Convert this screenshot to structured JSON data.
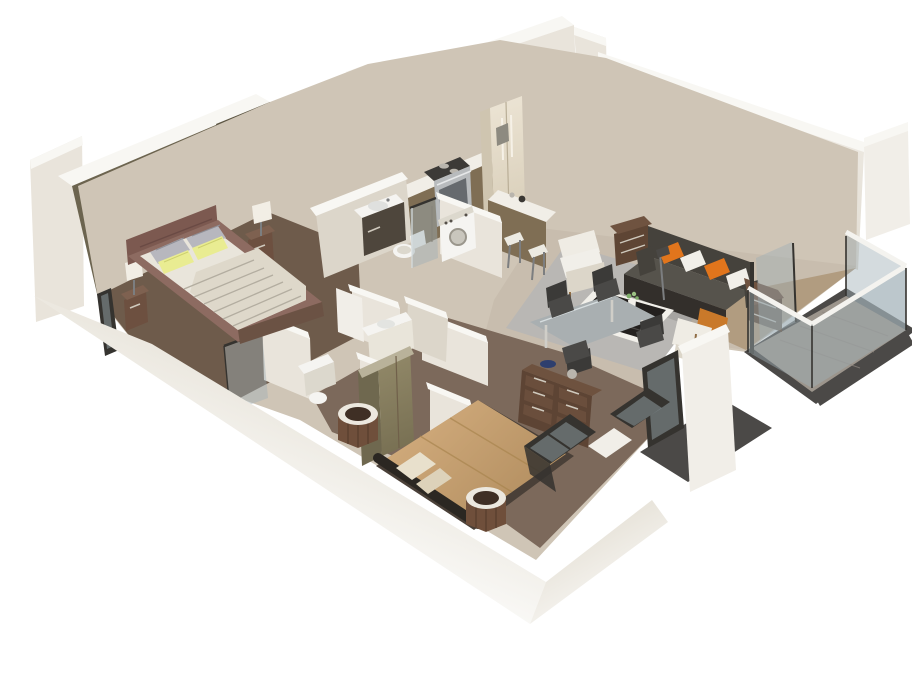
{
  "scene": {
    "title": "3D isometric cutaway floor plan render of a one-bedroom-plus-den apartment",
    "type": "isometric-cutaway-floor-plan",
    "background": "#ffffff",
    "rooms": [
      {
        "name": "master-bedroom",
        "features": [
          "abstract-pink-painting",
          "double-bed-striped-linens",
          "yellow-accent-pillows",
          "nightstands",
          "table-lamps",
          "olive-closet",
          "window"
        ]
      },
      {
        "name": "bathroom-main",
        "features": [
          "dark-vanity-white-sink",
          "toilet",
          "washer",
          "glass-shower-screen"
        ]
      },
      {
        "name": "bathroom-second",
        "features": [
          "white-sink-counter"
        ]
      },
      {
        "name": "ensuite-bathroom",
        "features": [
          "glass-shower-panel",
          "sink",
          "toilet"
        ]
      },
      {
        "name": "kitchen",
        "features": [
          "wood-upper-cabinets",
          "microwave",
          "marble-backsplash",
          "gas-range",
          "wood-base-cabinets",
          "refrigerator",
          "breakfast-bar",
          "bar-stools"
        ]
      },
      {
        "name": "entry",
        "features": [
          "wood-panel-door"
        ]
      },
      {
        "name": "living-room",
        "features": [
          "red-abstract-artwork",
          "dark-gray-sofa",
          "orange-and-white-pillows",
          "wood-end-tables",
          "black-coffee-table-white-frame",
          "flower-vase",
          "white-armchairs",
          "orange-back-armchair",
          "gray-area-rug",
          "floor-lamp",
          "sliding-glass-door"
        ]
      },
      {
        "name": "dining-area",
        "features": [
          "glass-top-table",
          "dark-chairs"
        ]
      },
      {
        "name": "second-bedroom",
        "features": [
          "tan-bed",
          "dark-bolster",
          "drum-side-tables",
          "six-drawer-dresser",
          "blue-bowl",
          "olive-wardrobe",
          "framed-windows"
        ]
      },
      {
        "name": "balcony",
        "features": [
          "glass-railing-white-cap",
          "dark-rim-floor"
        ]
      }
    ]
  },
  "palette": {
    "bg": "#ffffff",
    "wallTop": "#f8f7f3",
    "wallFace": "#e9e4db",
    "wallShade": "#dcd6ca",
    "wallBright": "#f1eee8",
    "oliveWall": "#6c644f",
    "oliveDark": "#5c5543",
    "kitchenWall": "#57504a",
    "cabinetDark": "#7f6e54",
    "counter": "#f1eee7",
    "backsplash": "#9aa3a3",
    "stainless": "#b8bbbd",
    "stainDark": "#55575a",
    "ovenGlass": "#666a6e",
    "fridgeSide": "#cfc5b0",
    "artFrame": "#34302d",
    "artRed": "#bf2717",
    "artDark": "#4a150d",
    "matEdge": "#d8d2c8",
    "floorHall": "#cfc5b6",
    "floorMaster": "#6e5b4b",
    "floorLiving": "#c8bdae",
    "floorBed2": "#7c695b",
    "woodStrip": "#b19c80",
    "rug": "#b9b7b4",
    "balconyFloor": "#9c958c",
    "balconyRim": "#4b4947",
    "plank": "#8e8780",
    "glass": "#9fb0b6",
    "glassFrame": "#35332f",
    "railWhite": "#f4f3ef",
    "glassSheen": "#d7dee0",
    "sofa": "#45423c",
    "sofaSeat": "#56534c",
    "sofaDark": "#332f2b",
    "orange": "#e1751c",
    "pillowWhite": "#f1efe9",
    "endTable": "#5e4534",
    "endTableTop": "#6f5340",
    "coffeeTop": "#23201e",
    "coffeeWhite": "#f2f0ea",
    "armWhite": "#efece4",
    "armBase": "#dcd6c9",
    "armOrange": "#c9792a",
    "armWood": "#8f6c44",
    "diningTop": "#a9afb1",
    "chairDark": "#3b3a38",
    "chairSeat": "#4a4947",
    "stoolSeat": "#eceae2",
    "metal": "#7c7e80",
    "bedHead": "#7c5950",
    "bedSide": "#8d6b61",
    "mattress": "#e9e5db",
    "sheet": "#ded8ca",
    "sheetStripe": "#b3ada0",
    "footboard": "#6b5244",
    "pillowGray": "#b7b7be",
    "pillowYellow": "#e9ec92",
    "pillowYellowLine": "#cdd06e",
    "nightstand": "#6d5040",
    "nightstandTop": "#7e6150",
    "lamp": "#f2eee5",
    "fixture": "#f5f4f1",
    "fixtureShade": "#dcd8cd",
    "vanityDark": "#4e463c",
    "wardrobeSide": "#6f684f",
    "wardrobeTop": "#b9b29a",
    "dresser": "#5d4434",
    "dresserTop": "#6e523f",
    "drawer": "#6a4e3c",
    "handle": "#cfc9bd",
    "bowlBlue": "#2e3f6e",
    "silver": "#b9b5ad",
    "bed2Base": "#4a4038",
    "tanFold": "#a8854f",
    "bolster": "#2b2722",
    "creamPillow": "#e8e0cc",
    "creamPillow2": "#ddd2ba",
    "stoolWood": "#6f4f3b",
    "stoolRim": "#ece8df",
    "stoolTop": "#3f2f25",
    "stoolSlat": "#5a3f2f",
    "cabLine": "#70604a",
    "shadow": "rgba(0,0,0,0.10)"
  }
}
